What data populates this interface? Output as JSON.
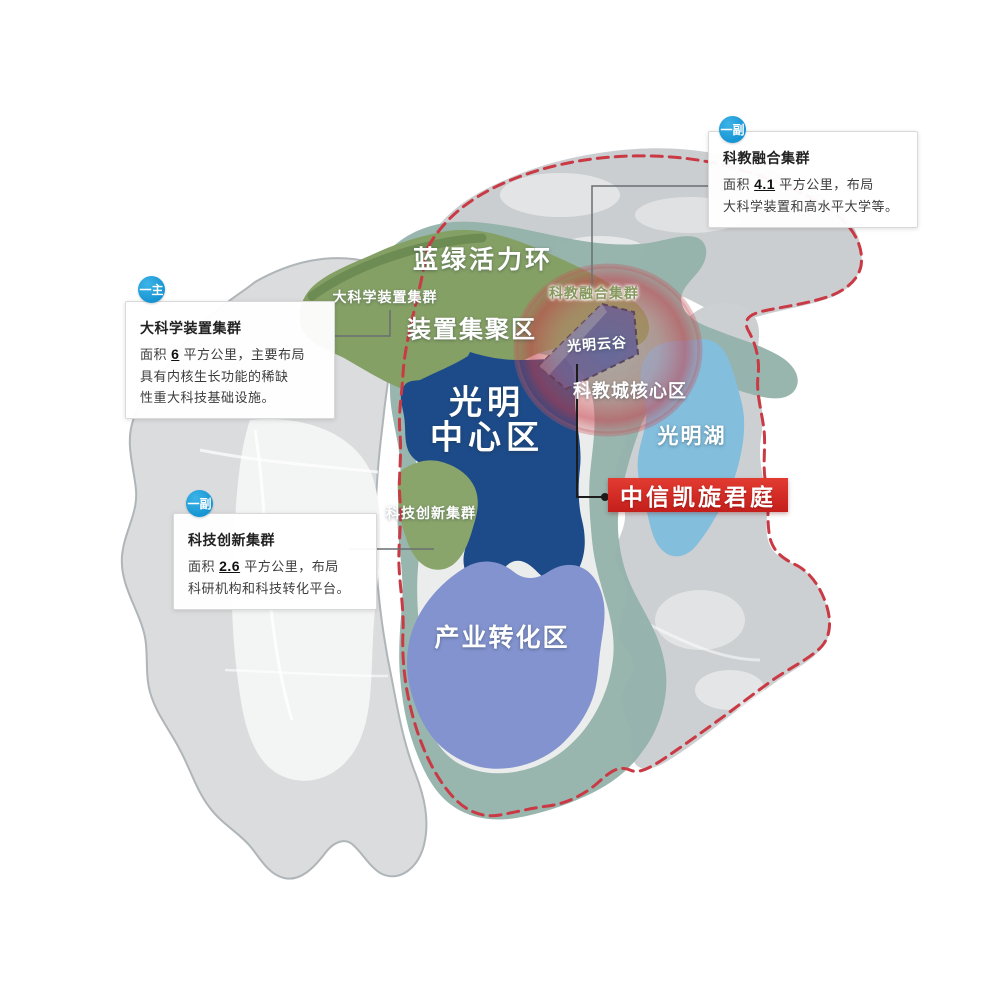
{
  "map": {
    "labels": {
      "ring": "蓝绿活力环",
      "big_science_cluster": "大科学装置集群",
      "device_zone": "装置集聚区",
      "sci_edu_cluster": "科教融合集群",
      "cloud_valley": "光明云谷",
      "sci_edu_core": "科教城核心区",
      "center_line1": "光明",
      "center_line2": "中心区",
      "lake": "光明湖",
      "tech_innovation_cluster": "科技创新集群",
      "industry_zone": "产业转化区"
    },
    "colors": {
      "teal_ring": "#94b3ab",
      "zone_green": "#85a065",
      "zone_dark_blue": "#1d4b89",
      "zone_periwinkle": "#8393cf",
      "lake_blue": "#83bedd",
      "highlight_red": "#cd4a4e",
      "boundary_red": "#c93a45",
      "badge_blue": "#1694d3",
      "badge_red": "#d0241f",
      "land_gray": "#d0d3d5"
    }
  },
  "callouts": {
    "sci_edu": {
      "badge": "一副",
      "title": "科教融合集群",
      "body": [
        [
          {
            "t": "面积 "
          },
          {
            "t": "4.1",
            "b": true
          },
          {
            "t": " 平方公里，布局"
          }
        ],
        [
          {
            "t": "大科学装置和高水平大学等。"
          }
        ]
      ]
    },
    "big_science": {
      "badge": "一主",
      "title": "大科学装置集群",
      "body": [
        [
          {
            "t": "面积 "
          },
          {
            "t": "6",
            "b": true
          },
          {
            "t": " 平方公里，主要布局"
          }
        ],
        [
          {
            "t": "具有内核生长功能的稀缺"
          }
        ],
        [
          {
            "t": "性重大科技基础设施。"
          }
        ]
      ]
    },
    "tech_innovation": {
      "badge": "一副",
      "title": "科技创新集群",
      "body": [
        [
          {
            "t": "面积 "
          },
          {
            "t": "2.6",
            "b": true
          },
          {
            "t": " 平方公里，布局"
          }
        ],
        [
          {
            "t": "科研机构和科技转化平台。"
          }
        ]
      ]
    }
  },
  "property_badge": {
    "label": "中信凯旋君庭"
  }
}
